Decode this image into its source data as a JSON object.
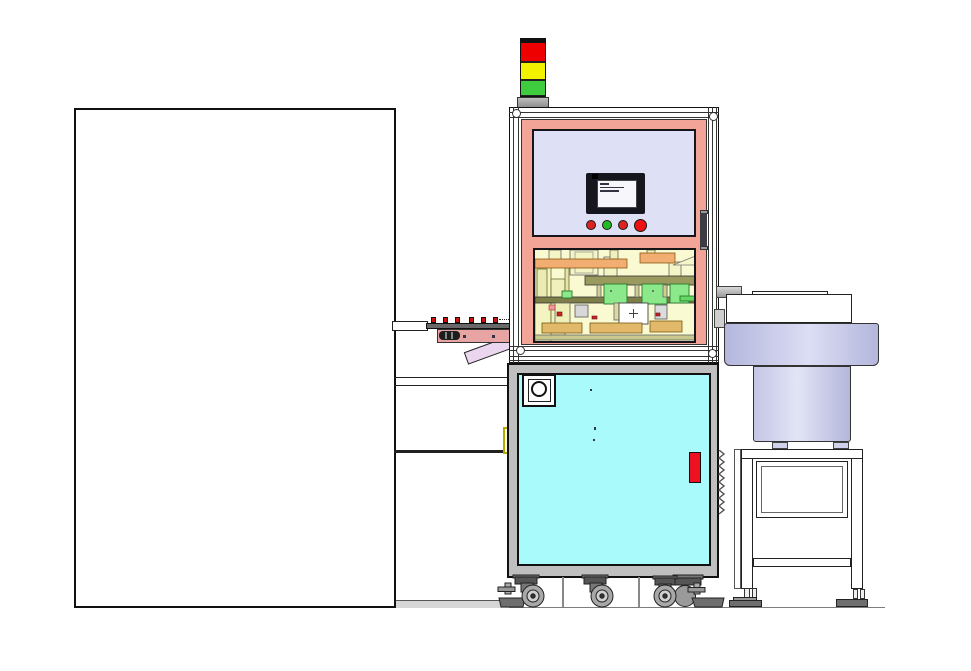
{
  "title": "Automated assembly machine - front elevation CAD drawing",
  "canvas": {
    "width": 971,
    "height": 671
  },
  "colors": {
    "panel-pink": "#F2A497",
    "window-lavender": "#DEE1F6",
    "door-cyan": "#A9FAFA",
    "cabinet-gray": "#BFBFBF",
    "mech-bg": "#FAFAD2",
    "mech-green": "#8BE88B",
    "mech-orange": "#F2AE72",
    "mech-tan": "#E2B96A",
    "handle-red": "#EE1122",
    "part-red": "#CC1111",
    "conveyor-pink": "#E8A3A3",
    "chute-pink": "#EBD6F0",
    "light-red": "#EE0000",
    "light-yellow": "#F2F200",
    "light-green": "#3ECC3E",
    "btn-red": "#DD2222",
    "btn-green": "#22BB22",
    "estop-red": "#EE1111",
    "ground-gray": "#D6D6D6",
    "bowl-hi": "#DCDEF4",
    "bowl-lo": "#B4B6DC"
  },
  "components": {
    "left_machine": "adjacent-machine-outline",
    "stack_light": {
      "segments": [
        "red",
        "yellow",
        "green"
      ]
    },
    "control_panel": {
      "hmi": "hmi-touchscreen",
      "buttons": [
        "red-pushbutton",
        "green-pushbutton",
        "red-pushbutton",
        "emergency-stop-button"
      ]
    },
    "upper_enclosure": {
      "door_window": "clear-door-window",
      "mechanism_bay": "assembly-mechanism-bay",
      "door_handle": "enclosure-door-handle"
    },
    "lower_cabinet": {
      "door": "cyan-cabinet-door",
      "vent": "round-vent",
      "handle": "red-door-handle"
    },
    "mobility": {
      "casters": 4,
      "leveling_feet": 2
    },
    "conveyor": {
      "parts_count": 6,
      "chute": "discharge-chute"
    },
    "bowl_feeder": {
      "bowl": "vibratory-bowl",
      "stand": "bowl-feeder-stand"
    }
  }
}
